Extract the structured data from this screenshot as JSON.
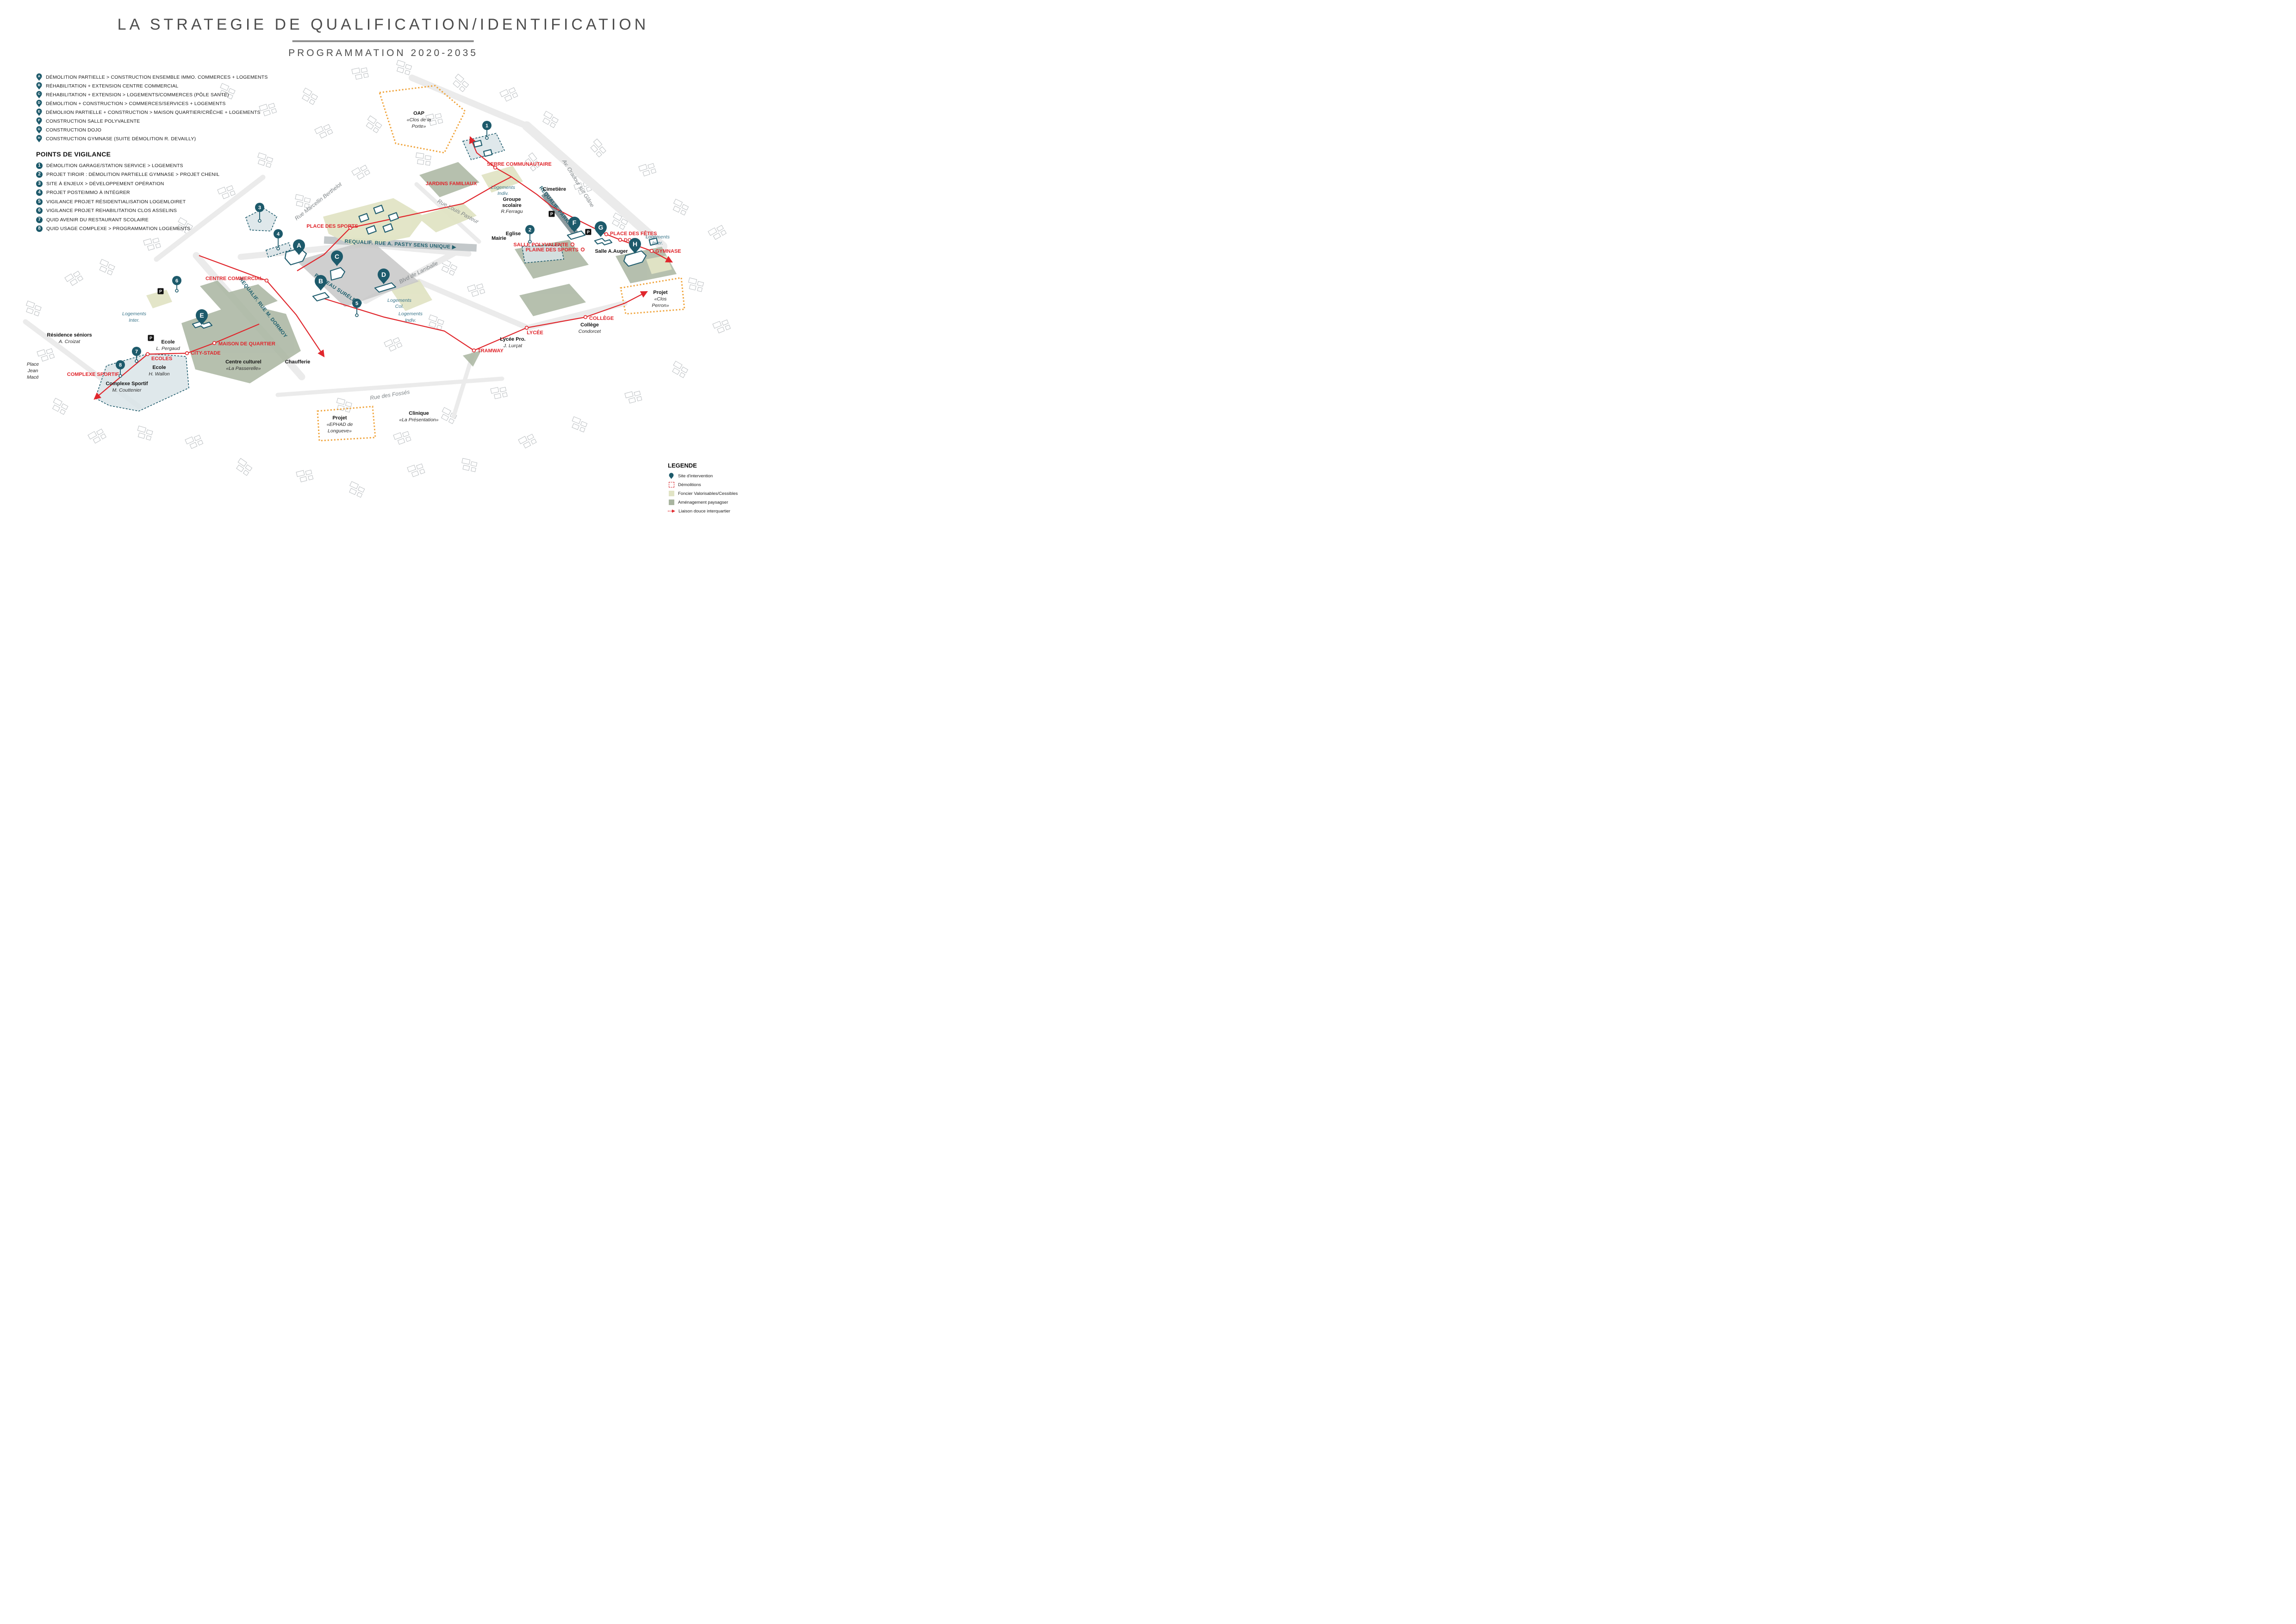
{
  "header": {
    "title": "LA STRATEGIE DE QUALIFICATION/IDENTIFICATION",
    "subtitle": "PROGRAMMATION 2020-2035"
  },
  "program_legend": {
    "items": [
      {
        "letter": "A",
        "label": "DÉMOLITION PARTIELLE > CONSTRUCTION ENSEMBLE IMMO. COMMERCES + LOGEMENTS"
      },
      {
        "letter": "B",
        "label": "RÉHABILITATION + EXTENSION CENTRE COMMERCIAL"
      },
      {
        "letter": "C",
        "label": "RÉHABILITATION + EXTENSION > LOGEMENTS/COMMERCES (PÔLE SANTÉ)"
      },
      {
        "letter": "D",
        "label": "DÉMOLITION + CONSTRUCTION > COMMERCES/SERVICES + LOGEMENTS"
      },
      {
        "letter": "E",
        "label": "DÉMOLIION PARTIELLE + CONSTRUCTION > MAISON QUARTIER/CRÊCHE + LOGEMENTS"
      },
      {
        "letter": "F",
        "label": "CONSTRUCTION SALLE POLYVALENTE"
      },
      {
        "letter": "G",
        "label": "CONSTRUCTION DOJO"
      },
      {
        "letter": "H",
        "label": "CONSTRUCTION GYMNASE (SUITE DÉMOLITION R. DEVAILLY)"
      }
    ]
  },
  "vigilance": {
    "heading": "POINTS DE VIGILANCE",
    "items": [
      {
        "num": "1",
        "label": "DÉMOLITION GARAGE/STATION SERVICE > LOGEMENTS"
      },
      {
        "num": "2",
        "label": "PROJET TIROIR : DÉMOLITION PARTIELLE GYMNASE > PROJET CHENIL"
      },
      {
        "num": "3",
        "label": "SITE À ENJEUX > DÉVELOPPEMENT OPÉRATION"
      },
      {
        "num": "4",
        "label": "PROJET POSTEIMMO À INTÉGRER"
      },
      {
        "num": "5",
        "label": "VIGILANCE PROJET RÉSIDENTIALISATION LOGEMLOIRET"
      },
      {
        "num": "6",
        "label": "VIGILANCE PROJET REHABILITATION CLOS ASSELINS"
      },
      {
        "num": "7",
        "label": "QUID AVENIR DU RESTAURANT SCOLAIRE"
      },
      {
        "num": "8",
        "label": "QUID USAGE COMPLEXE > PROGRAMMATION LOGEMENTS"
      }
    ]
  },
  "legend": {
    "heading": "LEGENDE",
    "items": [
      "Site d'intervention",
      "Démolitions",
      "Foncier Valorisables/Cessibles",
      "Aménagement paysagser",
      "Liaison douce interquartier"
    ]
  },
  "map": {
    "pins": [
      {
        "letter": "A"
      },
      {
        "letter": "B"
      },
      {
        "letter": "C"
      },
      {
        "letter": "D"
      },
      {
        "letter": "E"
      },
      {
        "letter": "F"
      },
      {
        "letter": "G"
      },
      {
        "letter": "H"
      }
    ],
    "numbers": [
      {
        "num": "1"
      },
      {
        "num": "2"
      },
      {
        "num": "3"
      },
      {
        "num": "4"
      },
      {
        "num": "5"
      },
      {
        "num": "6"
      },
      {
        "num": "7"
      },
      {
        "num": "8"
      }
    ],
    "parking_label": "P",
    "red_labels": [
      "SERRE COMMUNAUTAIRE",
      "JARDINS FAMILIAUX",
      "PLACE DES SPORTS",
      "CENTRE COMMERCIAL",
      "MAISON DE QUARTIER",
      "CITY-STADE",
      "ECOLES",
      "COMPLEXE SPORTIF",
      "SALLE POLYVALENTE",
      "PLAINE DES SPORTS",
      "PLACE DES FÊTES",
      "DOJO",
      "GYMNASE",
      "LYCÉE",
      "TRAMWAY",
      "COLLÈGE"
    ],
    "teal_road_labels": [
      "REQUALIF. RUE A. PASTY SENS UNIQUE  ▶",
      "REQUALIF. RUE M. DORMOY",
      "REQUALIF. PARKING",
      "PLATEAU SURÉLEVÉ"
    ],
    "road_labels": [
      "Rue Marcellin Berthelot",
      "Blvd de Lamballe",
      "Rue Louis Pasteur",
      "Rue des Fossés",
      "Av. Oradour sur Glâne"
    ],
    "black_labels": [
      {
        "l1": "Cimetière"
      },
      {
        "l1": "Groupe",
        "l2": "scolaire",
        "l3": "R.Ferragu"
      },
      {
        "l1": "Eglise"
      },
      {
        "l1": "Mairie"
      },
      {
        "l1": "Salle A.Auger"
      },
      {
        "l1": "Résidence séniors",
        "l2": "A. Croizat"
      },
      {
        "l1": "Place",
        "l2": "Jean",
        "l3": "Macé"
      },
      {
        "l1": "Ecole",
        "l2": "L. Pergaud"
      },
      {
        "l1": "Ecole",
        "l2": "H. Wallon"
      },
      {
        "l1": "Complexe Sportif",
        "l2": "M. Couttenier"
      },
      {
        "l1": "Centre culturel",
        "l2": "«La Passerelle»"
      },
      {
        "l1": "Chaufferie"
      },
      {
        "l1": "Projet",
        "l2": "«EPHAD de",
        "l3": "Longueve»"
      },
      {
        "l1": "Clinique",
        "l2": "«La Présentation»"
      },
      {
        "l1": "Collège",
        "l2": "Condorcet"
      },
      {
        "l1": "Lycée Pro.",
        "l2": "J. Lurçat"
      },
      {
        "l1": "Projet",
        "l2": "«Clos",
        "l3": "Perron»"
      },
      {
        "l1": "OAP",
        "l2": "«Clos de la",
        "l3": "Porte»"
      }
    ],
    "teal_area_labels": [
      {
        "l1": "Logements",
        "l2": "Inter."
      },
      {
        "l1": "Logements",
        "l2": "Col."
      },
      {
        "l1": "Logements",
        "l2": "Indiv."
      },
      {
        "l1": "Logements",
        "l2": "Indiv."
      },
      {
        "l1": "Logements",
        "l2": "Inter."
      }
    ],
    "colors": {
      "site_teal": "#1d5a6b",
      "liaison_red": "#e0262c",
      "foncier": "#e1e4c5",
      "paysager": "#a9b5a0",
      "zone_blue": "#d9e4e8",
      "oap_orange": "#f0a43c",
      "plateau_gray": "#c7c7c7"
    }
  }
}
